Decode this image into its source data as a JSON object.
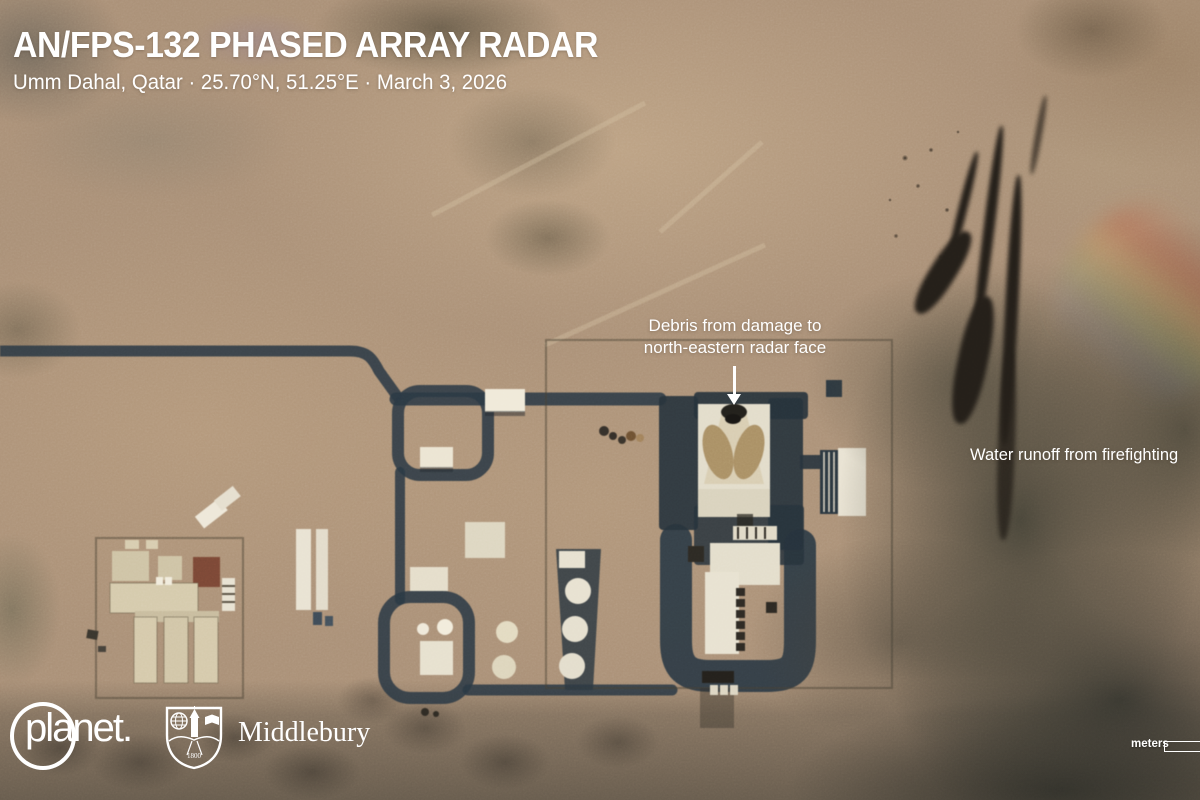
{
  "header": {
    "title": "AN/FPS-132 PHASED ARRAY RADAR",
    "subtitle": "Umm Dahal, Qatar · 25.70°N, 51.25°E · March 3, 2026"
  },
  "annotations": {
    "debris_line1": "Debris from damage to",
    "debris_line2": "north-eastern radar face",
    "water_runoff": "Water runoff from firefighting"
  },
  "credits": {
    "imagery_provider": "planet.",
    "analysis_org": "Middlebury",
    "shield_year": "1800"
  },
  "scale_bar": {
    "unit_label": "meters"
  },
  "colors": {
    "annotation_text": "#ffffff",
    "terrain_base": "#ab9178",
    "road_asphalt": "#2b3944",
    "building_light": "#e8e2d1",
    "radar_face_tan": "#ab9166",
    "burn_smoke": "#241f19",
    "runoff_stain": "#3a3a32"
  }
}
